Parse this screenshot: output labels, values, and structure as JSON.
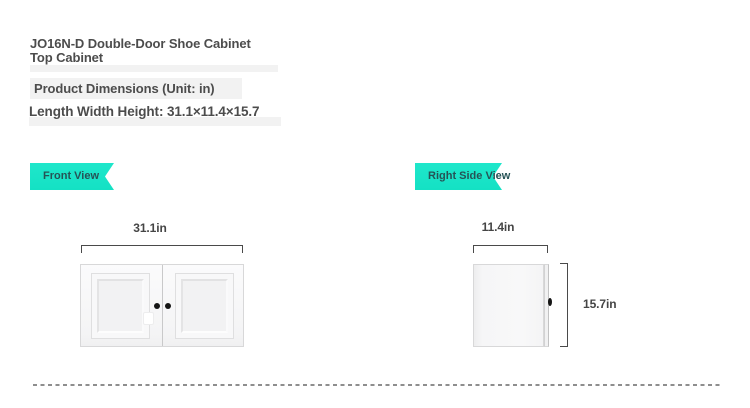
{
  "header": {
    "title_line1": "JO16N-D Double-Door Shoe Cabinet",
    "title_line2": "Top Cabinet",
    "subtitle": "Product Dimensions (Unit: in)",
    "dimensions_summary": "Length Width Height: 31.1×11.4×15.7"
  },
  "front_view": {
    "label": "Front View",
    "width_dimension": "31.1in"
  },
  "right_side_view": {
    "label": "Right Side View",
    "width_dimension": "11.4in",
    "height_dimension": "15.7in"
  },
  "colors": {
    "ribbon": "#14e1c4",
    "ribbon_text": "#265356",
    "heading_text": "#4c4c4c",
    "dimension_text": "#454545",
    "dimension_line": "#4a4a4a",
    "knob": "#151515",
    "dashed_line": "#8e8e8e",
    "cabinet_border": "#d8d8d9",
    "cabinet_fill": "#f4f4f5",
    "highlight_bar": "#f2f2f2"
  }
}
